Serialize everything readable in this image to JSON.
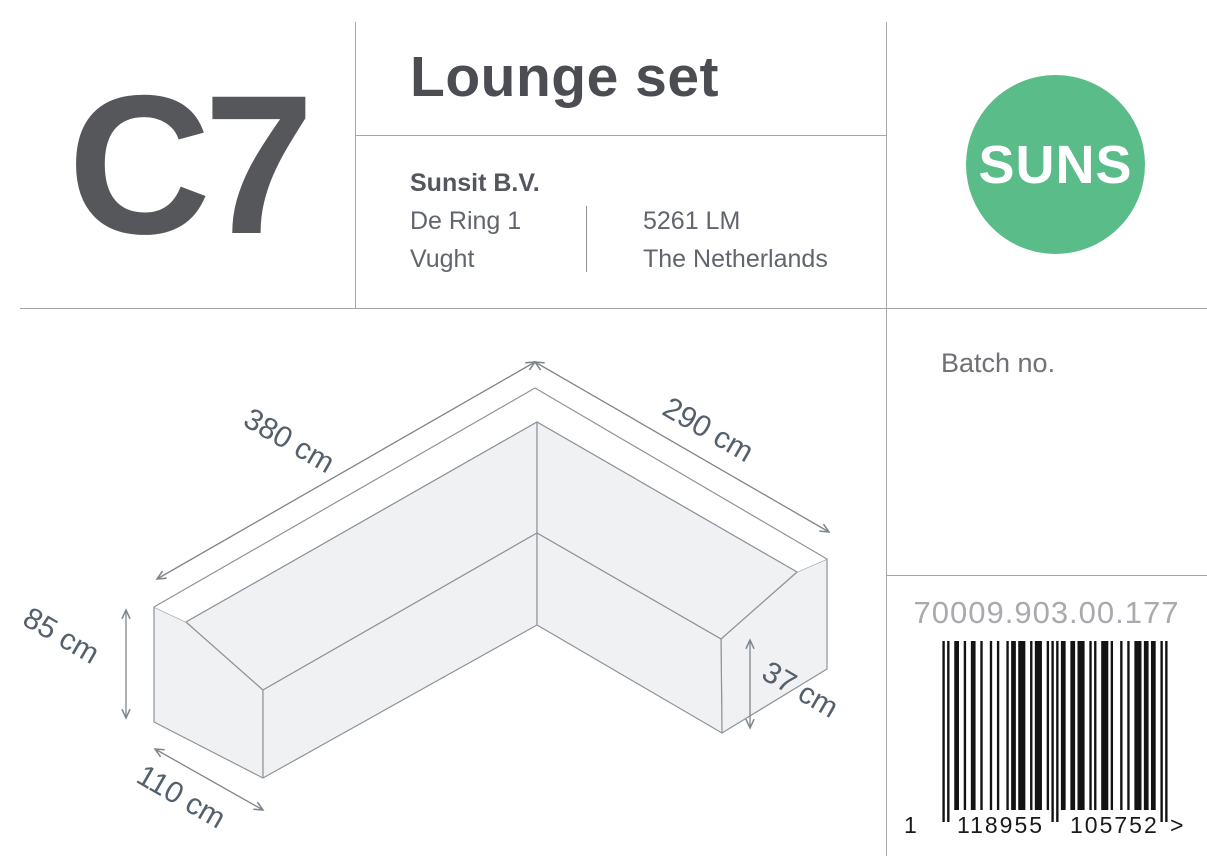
{
  "header": {
    "product_code": "C7",
    "product_name": "Lounge set",
    "manufacturer": {
      "name": "Sunsit B.V.",
      "street": "De Ring 1",
      "city": "Vught",
      "postal_code": "5261 LM",
      "country": "The Netherlands"
    },
    "logo_text": "SUNS"
  },
  "side_panel": {
    "batch_label": "Batch no.",
    "article_number": "70009.903.00.177",
    "barcode": {
      "value": "1118955105752",
      "digit_first": "1",
      "digits_left": "118955",
      "digits_right": "105752",
      "suffix": ">"
    }
  },
  "diagram": {
    "dim_length_left": "380 cm",
    "dim_length_right": "290 cm",
    "dim_height_back": "85 cm",
    "dim_depth": "110 cm",
    "dim_height_front": "37 cm"
  },
  "colors": {
    "logo_green": "#5abc88",
    "dimension_text": "#55606d",
    "barcode_ink": "#131313"
  }
}
